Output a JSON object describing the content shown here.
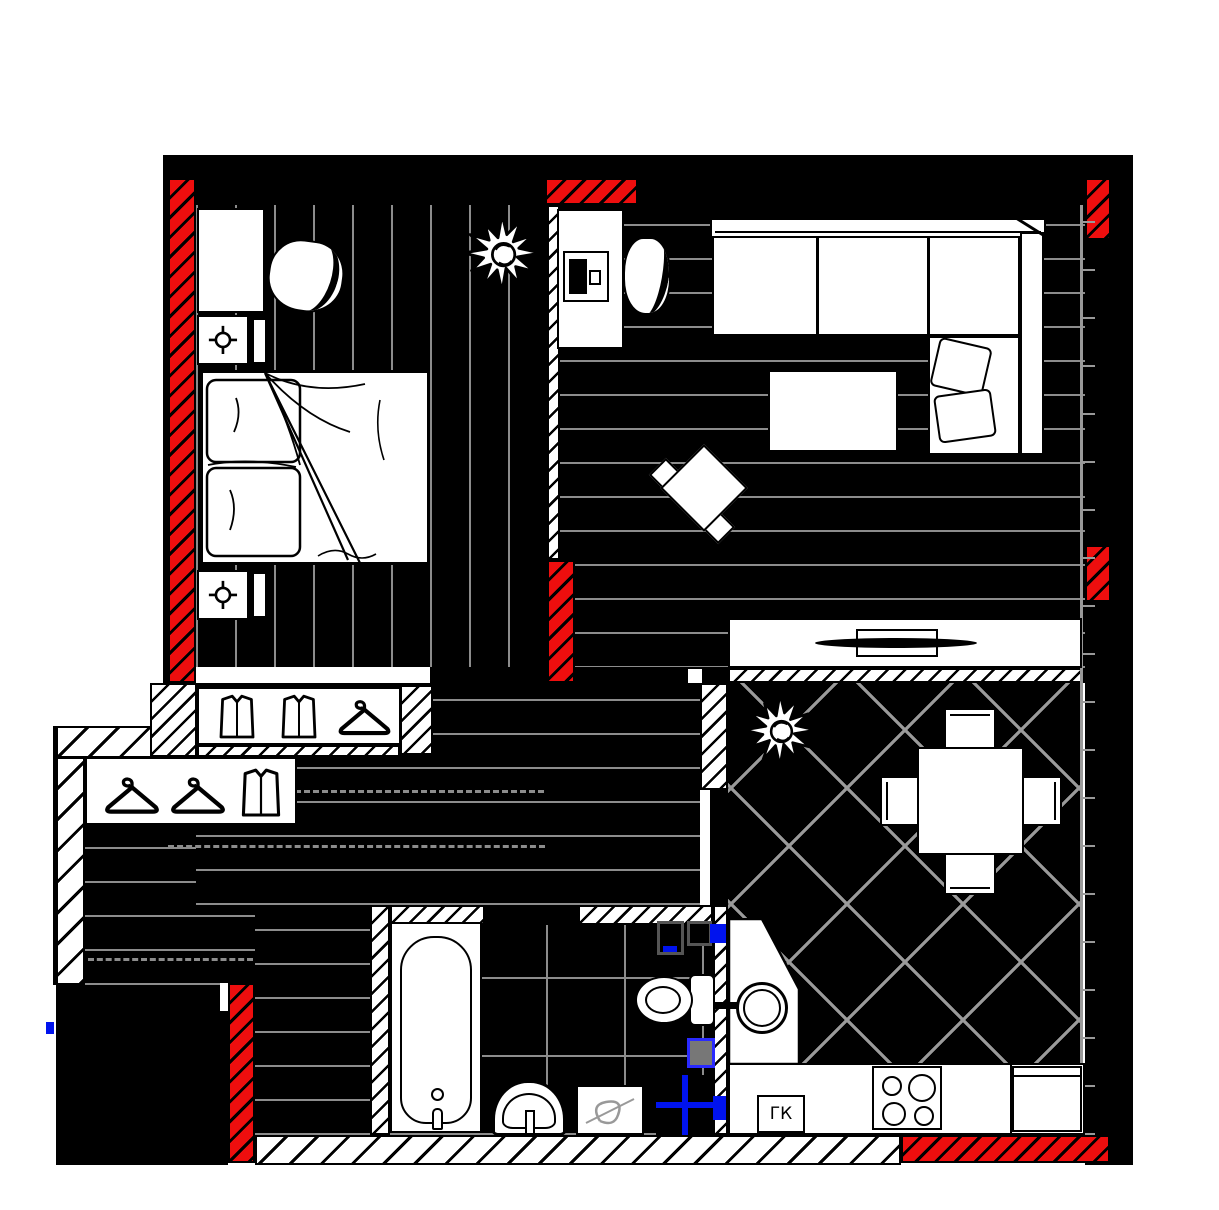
{
  "labels": {
    "gas_boiler": "ГК"
  },
  "palette": {
    "wall_fill": "#000000",
    "masonry_red": "#ee0e0e",
    "plumbing_blue": "#0013ee",
    "floor_joint_gray": "#8c8c8c",
    "paper_white": "#ffffff"
  },
  "floor_plan": {
    "wall_types": [
      "solid-black",
      "thin-diagonal-hatch",
      "thick-diagonal-hatch",
      "red-masonry-hatch"
    ],
    "rooms": [
      {
        "id": "bedroom",
        "floor_pattern": "vertical-planks",
        "items": [
          "wardrobe",
          "bedside-table-with-light",
          "lounge-chair",
          "plant",
          "double-bed",
          "bedside-table-with-light"
        ]
      },
      {
        "id": "living-room",
        "floor_pattern": "horizontal-planks",
        "items": [
          "desk",
          "laptop",
          "desk-chair",
          "corner-sofa",
          "cushions",
          "coffee-table",
          "rotated-armchair",
          "tv-stand",
          "tv"
        ]
      },
      {
        "id": "hallway",
        "floor_pattern": "horizontal-planks",
        "items": [
          "closet-clothes-clothes-hanger",
          "closet-hanger-hanger-clothes"
        ]
      },
      {
        "id": "bathroom",
        "floor_pattern": "square-tiles",
        "items": [
          "bathtub",
          "washbasin",
          "washing-machine",
          "toilet",
          "plumbing-riser-boxes",
          "water-meter-cross-box"
        ]
      },
      {
        "id": "kitchen-dining",
        "floor_pattern": "diagonal-tiles",
        "items": [
          "plant",
          "dining-table-with-4-chairs",
          "corner-cabinet",
          "round-sink",
          "gas-boiler-box",
          "hob-4-burners",
          "fridge"
        ]
      }
    ]
  }
}
